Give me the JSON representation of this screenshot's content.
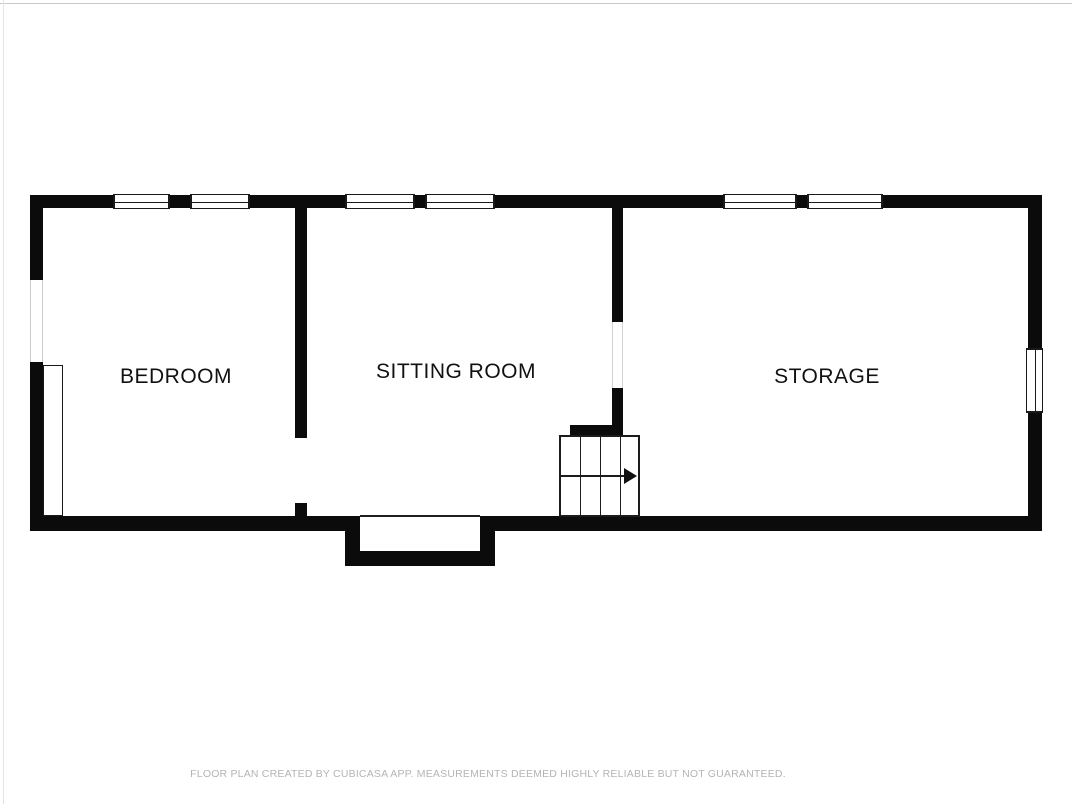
{
  "rooms": [
    {
      "label": "BEDROOM"
    },
    {
      "label": "SITTING ROOM"
    },
    {
      "label": "STORAGE"
    }
  ],
  "footer": {
    "disclaimer": "FLOOR PLAN CREATED BY CUBICASA APP. MEASUREMENTS DEEMED HIGHLY RELIABLE BUT NOT GUARANTEED."
  },
  "icons": {
    "stairs_arrow": "right-arrow"
  },
  "colors": {
    "wall": "#0b0b0b",
    "room_label": "#111111",
    "disclaimer_text": "#b4b4b4",
    "background": "#ffffff"
  }
}
